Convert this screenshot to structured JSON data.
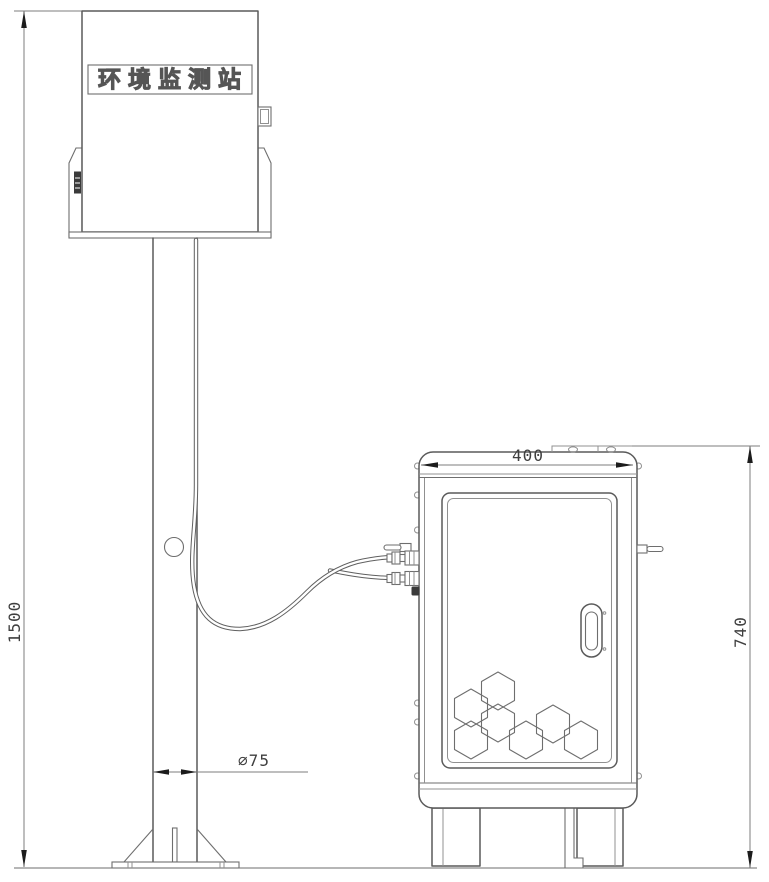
{
  "drawing": {
    "type": "technical-line-drawing",
    "station_label": "环境监测站",
    "dimensions": {
      "pole_height": "1500",
      "cabinet_width": "400",
      "cabinet_height": "740",
      "pole_diameter": "∅75"
    },
    "colors": {
      "outline": "#5a5a5a",
      "thin_line": "#909090",
      "dimension_line": "#7d7d7d",
      "arrow": "#1c1c1c",
      "text": "#3f3f3f",
      "background": "#ffffff"
    }
  }
}
